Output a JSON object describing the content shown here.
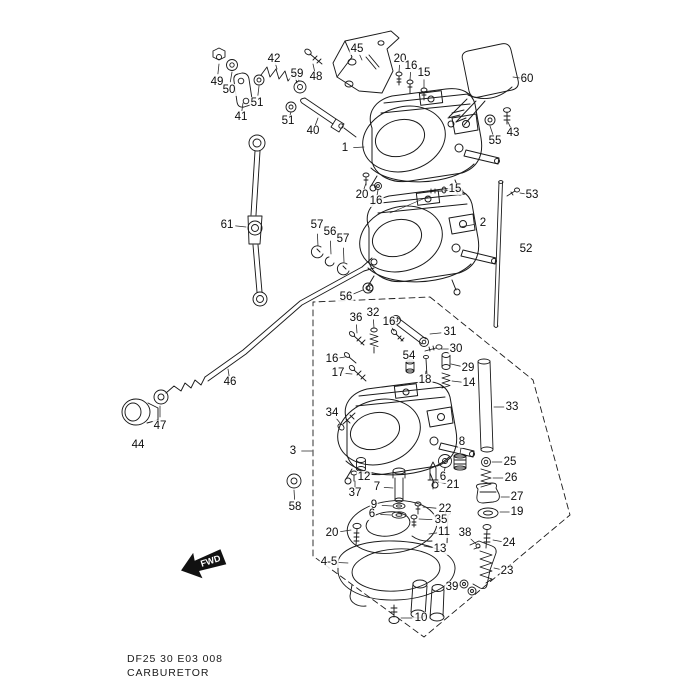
{
  "document": {
    "code_line": "DF25 30 E03 008",
    "title": "CARBURETOR"
  },
  "fwd_marker": {
    "label": "FWD"
  },
  "diagram": {
    "labels": [
      {
        "t": "49",
        "x": 217,
        "y": 82,
        "lx": 219,
        "ly": 64
      },
      {
        "t": "50",
        "x": 229,
        "y": 90,
        "lx": 232,
        "ly": 72
      },
      {
        "t": "41",
        "x": 241,
        "y": 117,
        "lx": 243,
        "ly": 103
      },
      {
        "t": "51",
        "x": 257,
        "y": 103,
        "lx": 259,
        "ly": 86
      },
      {
        "t": "42",
        "x": 274,
        "y": 59,
        "lx": 277,
        "ly": 69
      },
      {
        "t": "59",
        "x": 297,
        "y": 74,
        "lx": 299,
        "ly": 81
      },
      {
        "t": "51",
        "x": 288,
        "y": 121,
        "lx": 291,
        "ly": 112
      },
      {
        "t": "40",
        "x": 313,
        "y": 131,
        "lx": 318,
        "ly": 118
      },
      {
        "t": "48",
        "x": 316,
        "y": 77,
        "lx": 313,
        "ly": 64
      },
      {
        "t": "45",
        "x": 357,
        "y": 49,
        "lx": 362,
        "ly": 60
      },
      {
        "t": "20",
        "x": 400,
        "y": 59,
        "lx": 399,
        "ly": 72
      },
      {
        "t": "16",
        "x": 411,
        "y": 66,
        "lx": 410,
        "ly": 80
      },
      {
        "t": "15",
        "x": 424,
        "y": 73,
        "lx": 424,
        "ly": 88
      },
      {
        "t": "60",
        "x": 527,
        "y": 79,
        "lx": 513,
        "ly": 77
      },
      {
        "t": "43",
        "x": 513,
        "y": 133,
        "lx": 508,
        "ly": 122
      },
      {
        "t": "55",
        "x": 495,
        "y": 141,
        "lx": 490,
        "ly": 126
      },
      {
        "t": "1",
        "x": 345,
        "y": 148,
        "lx": 364,
        "ly": 147
      },
      {
        "t": "15",
        "x": 455,
        "y": 189,
        "lx": 444,
        "ly": 191
      },
      {
        "t": "20",
        "x": 362,
        "y": 195,
        "lx": 366,
        "ly": 183
      },
      {
        "t": "16",
        "x": 376,
        "y": 201,
        "lx": 378,
        "ly": 190
      },
      {
        "t": "2",
        "x": 483,
        "y": 223,
        "lx": 460,
        "ly": 227
      },
      {
        "t": "53",
        "x": 532,
        "y": 195,
        "lx": 520,
        "ly": 193
      },
      {
        "t": "52",
        "x": 526,
        "y": 249
      },
      {
        "t": "61",
        "x": 227,
        "y": 225,
        "lx": 246,
        "ly": 227
      },
      {
        "t": "57",
        "x": 317,
        "y": 225,
        "lx": 318,
        "ly": 246
      },
      {
        "t": "56",
        "x": 330,
        "y": 232,
        "lx": 331,
        "ly": 254
      },
      {
        "t": "57",
        "x": 343,
        "y": 239,
        "lx": 344,
        "ly": 262
      },
      {
        "t": "56",
        "x": 346,
        "y": 297,
        "lx": 363,
        "ly": 290
      },
      {
        "t": "46",
        "x": 230,
        "y": 382,
        "lx": 228,
        "ly": 369
      },
      {
        "t": "47",
        "x": 160,
        "y": 426,
        "lx": 160,
        "ly": 406
      },
      {
        "t": "44",
        "x": 138,
        "y": 445
      },
      {
        "t": "36",
        "x": 356,
        "y": 318,
        "lx": 357,
        "ly": 333
      },
      {
        "t": "32",
        "x": 373,
        "y": 313,
        "lx": 374,
        "ly": 328
      },
      {
        "t": "16",
        "x": 389,
        "y": 322,
        "lx": 394,
        "ly": 331
      },
      {
        "t": "31",
        "x": 450,
        "y": 332,
        "lx": 430,
        "ly": 334
      },
      {
        "t": "30",
        "x": 456,
        "y": 349,
        "lx": 441,
        "ly": 349
      },
      {
        "t": "54",
        "x": 409,
        "y": 356,
        "lx": 410,
        "ly": 362
      },
      {
        "t": "29",
        "x": 468,
        "y": 368,
        "lx": 451,
        "ly": 364
      },
      {
        "t": "18",
        "x": 425,
        "y": 380,
        "lx": 426,
        "ly": 371
      },
      {
        "t": "14",
        "x": 469,
        "y": 383,
        "lx": 452,
        "ly": 381
      },
      {
        "t": "17",
        "x": 338,
        "y": 373,
        "lx": 352,
        "ly": 374
      },
      {
        "t": "16",
        "x": 332,
        "y": 359,
        "lx": 345,
        "ly": 357
      },
      {
        "t": "34",
        "x": 332,
        "y": 413,
        "lx": 340,
        "ly": 423
      },
      {
        "t": "3",
        "x": 293,
        "y": 451,
        "lx": 312,
        "ly": 451
      },
      {
        "t": "33",
        "x": 512,
        "y": 407,
        "lx": 494,
        "ly": 407
      },
      {
        "t": "58",
        "x": 295,
        "y": 507,
        "lx": 294,
        "ly": 490
      },
      {
        "t": "12",
        "x": 364,
        "y": 477,
        "lx": 362,
        "ly": 470
      },
      {
        "t": "37",
        "x": 355,
        "y": 493,
        "lx": 355,
        "ly": 481
      },
      {
        "t": "7",
        "x": 377,
        "y": 487,
        "lx": 393,
        "ly": 488
      },
      {
        "t": "9",
        "x": 374,
        "y": 505,
        "lx": 392,
        "ly": 506
      },
      {
        "t": "6",
        "x": 372,
        "y": 514,
        "lx": 391,
        "ly": 515
      },
      {
        "t": "8",
        "x": 462,
        "y": 442,
        "lx": 460,
        "ly": 454
      },
      {
        "t": "6",
        "x": 443,
        "y": 477,
        "lx": 445,
        "ly": 468
      },
      {
        "t": "21",
        "x": 453,
        "y": 485,
        "lx": 438,
        "ly": 482
      },
      {
        "t": "22",
        "x": 445,
        "y": 509,
        "lx": 423,
        "ly": 507
      },
      {
        "t": "35",
        "x": 441,
        "y": 520,
        "lx": 419,
        "ly": 519
      },
      {
        "t": "25",
        "x": 510,
        "y": 462,
        "lx": 492,
        "ly": 462
      },
      {
        "t": "26",
        "x": 511,
        "y": 478,
        "lx": 493,
        "ly": 478
      },
      {
        "t": "27",
        "x": 517,
        "y": 497,
        "lx": 501,
        "ly": 497
      },
      {
        "t": "19",
        "x": 517,
        "y": 512,
        "lx": 500,
        "ly": 512
      },
      {
        "t": "20",
        "x": 332,
        "y": 533,
        "lx": 351,
        "ly": 530
      },
      {
        "t": "11",
        "x": 444,
        "y": 532,
        "lx": 429,
        "ly": 534
      },
      {
        "t": "13",
        "x": 440,
        "y": 549,
        "lx": 424,
        "ly": 546
      },
      {
        "t": "38",
        "x": 465,
        "y": 533,
        "lx": 476,
        "ly": 544
      },
      {
        "t": "24",
        "x": 509,
        "y": 543,
        "lx": 493,
        "ly": 540
      },
      {
        "t": "23",
        "x": 507,
        "y": 571,
        "lx": 494,
        "ly": 568
      },
      {
        "t": "4-5",
        "x": 329,
        "y": 562,
        "lx": 348,
        "ly": 563
      },
      {
        "t": "39",
        "x": 452,
        "y": 587,
        "lx": 460,
        "ly": 585
      },
      {
        "t": "10",
        "x": 421,
        "y": 618,
        "lx": 401,
        "ly": 618
      }
    ]
  }
}
